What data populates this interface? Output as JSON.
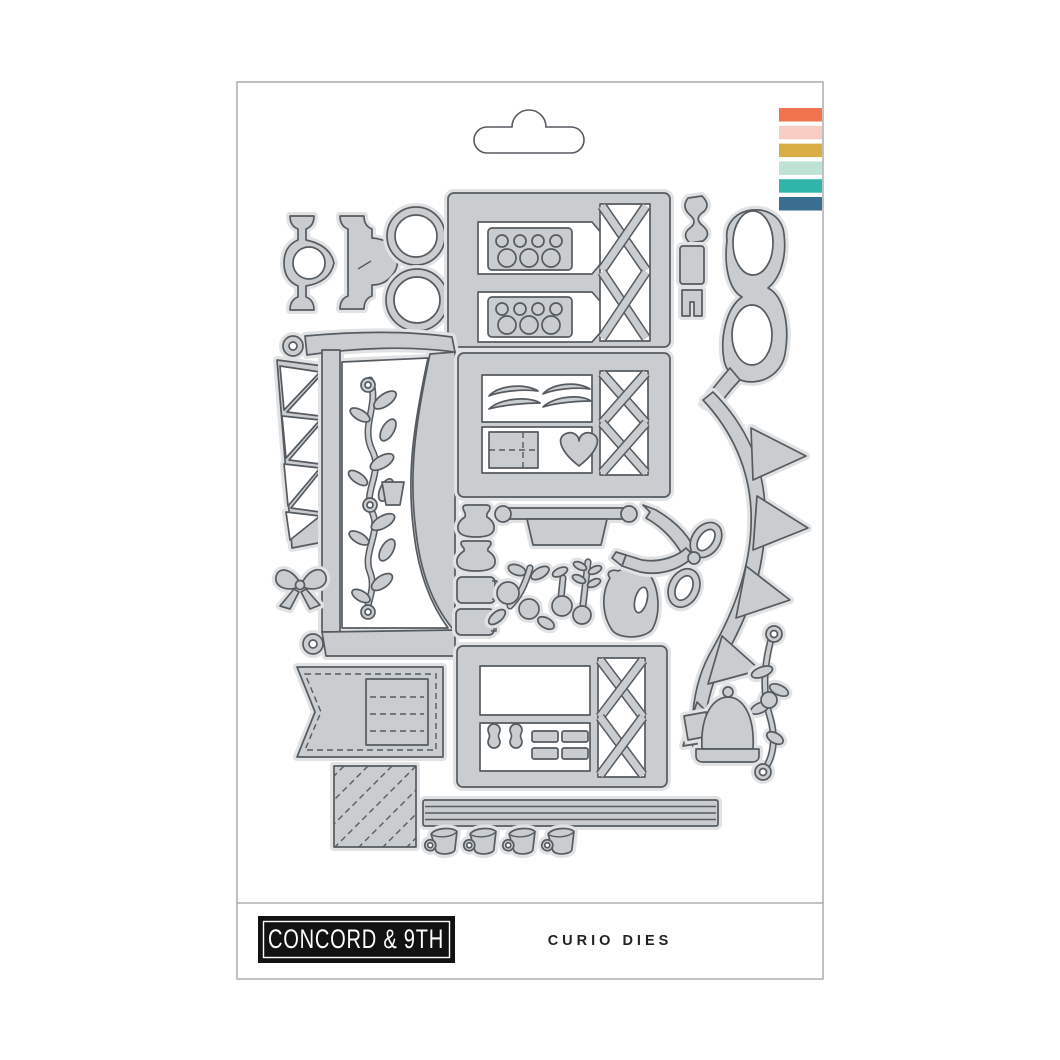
{
  "brand": {
    "logo_text": "CONCORD & 9TH"
  },
  "product": {
    "title": "CURIO DIES"
  },
  "package": {
    "swatch_colors": [
      "#F2744E",
      "#F8CDC3",
      "#D9AE45",
      "#BEE3D5",
      "#2FB5A9",
      "#3A6E91"
    ],
    "die_fill": "#c9cdcf",
    "die_edge": "#565b60",
    "halo": "#e0e2e3"
  },
  "die_shapes": [
    "ornate-bracket-pair",
    "circle-frames",
    "tag-panel-with-dot-banners",
    "squiggle-trim",
    "clasp",
    "oval-frames",
    "pennant-border",
    "flourish-mantel-with-vine",
    "small-bow",
    "panel-with-wings-envelope-heart",
    "hanging-sign",
    "jars-and-bottles",
    "berry-sprigs",
    "pitcher",
    "ribbon-bow",
    "bunting-swag",
    "scroll-flourish",
    "cake-dome",
    "stitched-banner-flag",
    "panel-with-labels",
    "diagonal-striped-square",
    "shelf-ledge",
    "teacups"
  ]
}
